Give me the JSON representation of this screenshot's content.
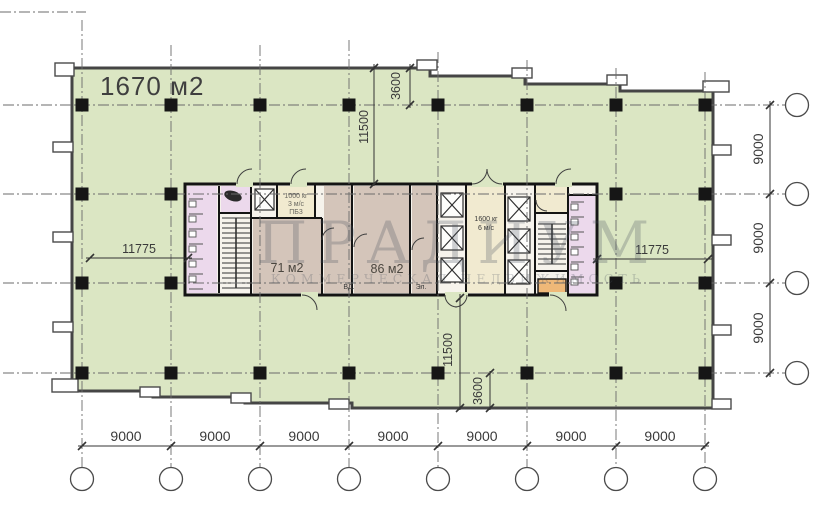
{
  "plan": {
    "area_label": "1670 м2",
    "watermark": {
      "title": "ПРАДИУМ",
      "subtitle": "КОММЕРЧЕСКАЯ НЕДВИЖИМОСТЬ"
    },
    "core": {
      "room_71": "71 м2",
      "room_86": "86 м2",
      "lift_small": {
        "l1": "1000 кг",
        "l2": "3 м/с",
        "l3": "ПБ3"
      },
      "lift_main": {
        "l1": "1600 кг",
        "l2": "6 м/с"
      },
      "el_label": "Эл.",
      "vd_label": "ВД."
    },
    "dims": {
      "bottom": [
        "9000",
        "9000",
        "9000",
        "9000",
        "9000",
        "9000",
        "9000"
      ],
      "right": [
        "9000",
        "9000",
        "9000"
      ],
      "left_width": "11775",
      "right_width": "11775",
      "top_depth": "11500",
      "top_offset": "3600",
      "bottom_depth": "11500",
      "bottom_offset": "3600"
    },
    "colors": {
      "floor_green": "#dbe6c3",
      "room_tan": "#d4c5ba",
      "room_pink": "#ecd9ec",
      "room_cream": "#f1ead0",
      "room_orange": "#efb878",
      "wall_black": "#1c1c1c",
      "grid_gray": "#6b6b6b"
    }
  }
}
